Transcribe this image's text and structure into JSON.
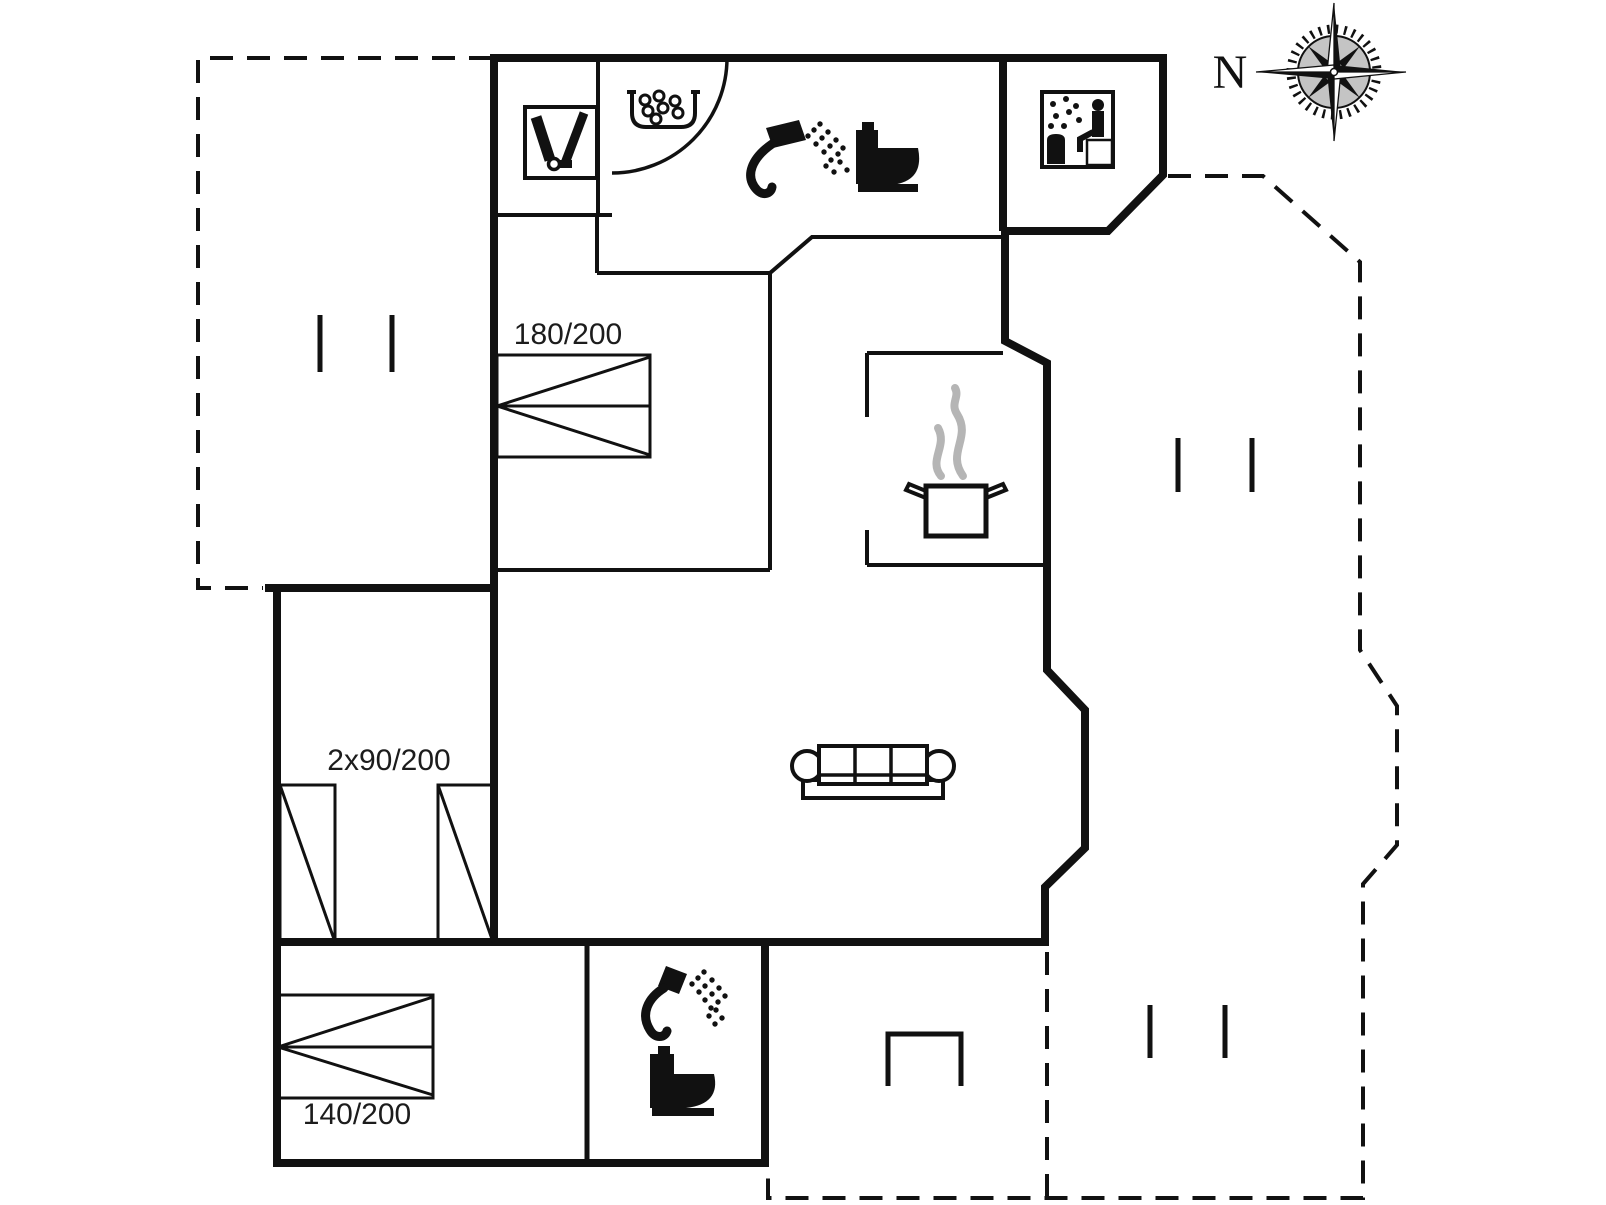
{
  "plan": {
    "type": "holiday-home-floor-plan",
    "compass": {
      "label": "N"
    },
    "bed_labels": {
      "large_double": "180/200",
      "twin": "2x90/200",
      "small_double": "140/200"
    },
    "rooms": {
      "features": [
        "utility-closet",
        "whirlpool",
        "bathroom-shower-toilet",
        "sauna",
        "kitchen-with-pot",
        "living-room-sofa",
        "bedroom-180-200",
        "bedroom-2x90-200",
        "bedroom-140-200",
        "bathroom-2-shower-toilet",
        "terrace-top-left",
        "terrace-right",
        "terrace-bottom"
      ]
    },
    "icons": {
      "cleaning": "cleaning-equipment-icon",
      "whirlpool": "whirlpool-icon",
      "shower": "shower-icon",
      "toilet": "toilet-icon",
      "sauna": "sauna-icon",
      "cooking_pot": "cooking-pot-icon",
      "steam": "steam-icon",
      "sofa": "sofa-icon",
      "grill": "grill-icon",
      "compass": "compass-rose-icon",
      "bed_double": "double-bed-symbol",
      "bed_single": "single-bed-symbol",
      "terrace_mark": "terrace-mark-icon",
      "door": "door-swing-arc-icon"
    },
    "colors": {
      "line": "#111111",
      "steam": "#b5b5b5",
      "compass_fill": "#8a8a8a",
      "background": "#ffffff"
    }
  }
}
